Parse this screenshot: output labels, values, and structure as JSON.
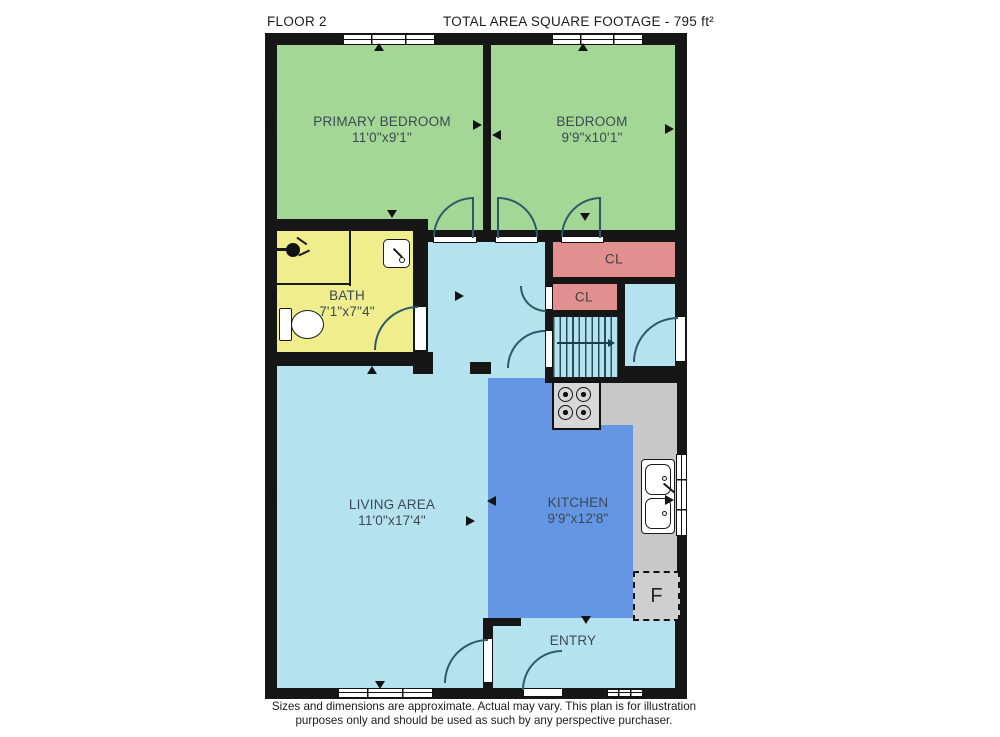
{
  "header": {
    "floor_label": "FLOOR 2",
    "total_area_label": "TOTAL AREA SQUARE FOOTAGE - 795 ft²"
  },
  "rooms": {
    "primary_bedroom": {
      "name": "PRIMARY BEDROOM",
      "dims": "11'0\"x9'1\""
    },
    "bedroom": {
      "name": "BEDROOM",
      "dims": "9'9\"x10'1\""
    },
    "bath": {
      "name": "BATH",
      "dims": "7'1\"x7\"4\""
    },
    "living_area": {
      "name": "LIVING AREA",
      "dims": "11'0\"x17'4\""
    },
    "kitchen": {
      "name": "KITCHEN",
      "dims": "9'9\"x12'8\""
    },
    "entry": {
      "name": "ENTRY"
    },
    "closet_top": {
      "name": "CL"
    },
    "closet_mid": {
      "name": "CL"
    },
    "fridge": {
      "label": "F"
    }
  },
  "footer": {
    "line1": "Sizes and dimensions are approximate. Actual may vary. This plan is for illustration",
    "line2": "purposes only and should be used as such by any perspective purchaser."
  },
  "colors": {
    "bedroom_green": "#a4d796",
    "bath_yellow": "#f0ed8c",
    "closet_pink": "#e18f8f",
    "light_blue": "#b4e3ef",
    "kitchen_blue": "#6496e3",
    "counter_gray": "#c8c8c8",
    "wall_black": "#161616",
    "door_arc": "#2d5a68",
    "label_text": "#394a52"
  },
  "icons": {
    "shower": "shower-icon",
    "toilet": "toilet-icon",
    "bath_sink": "sink-icon",
    "kitchen_sink": "double-sink-icon",
    "stove": "stove-icon",
    "stairs": "staircase",
    "fridge": "fridge-box"
  }
}
